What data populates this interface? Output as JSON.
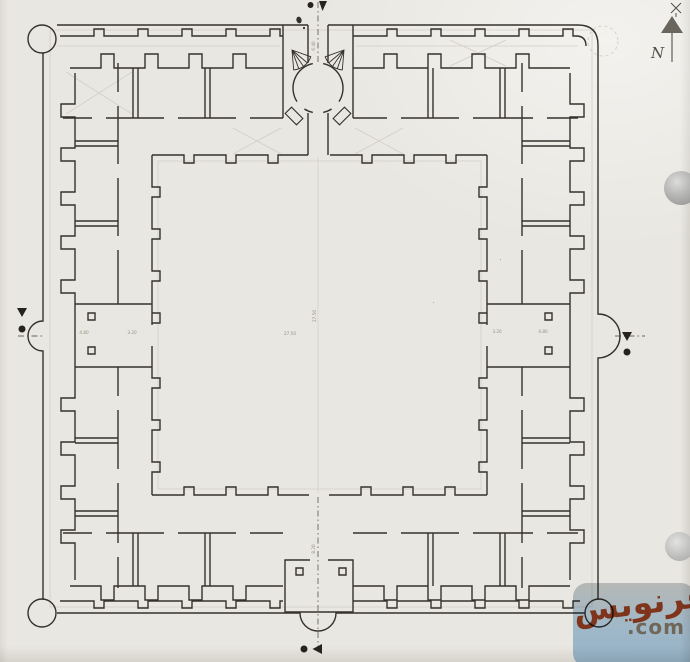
{
  "colors": {
    "paper": "#e9e7e1",
    "ink": "#35322b",
    "faint": "#d2cec5",
    "axis": "#6b665d",
    "dim_text": "#96907e",
    "marker": "#26231e",
    "north": "#55514a"
  },
  "north_indicator": {
    "label": "N"
  },
  "watermark": {
    "site_name": "سفرنویس",
    "tld": ".com",
    "badge_color": "#aecbe4",
    "name_color": "#8a3a1e",
    "tld_color": "#7b7265"
  },
  "dimensions": {
    "courtyard_width": "27.50",
    "courtyard_height": "27.50",
    "hall_left_a": "4.80",
    "hall_left_b": "3.20",
    "hall_right_a": "3.20",
    "hall_right_b": "4.80",
    "axis_south": "8.20",
    "axis_north": "6.40"
  }
}
